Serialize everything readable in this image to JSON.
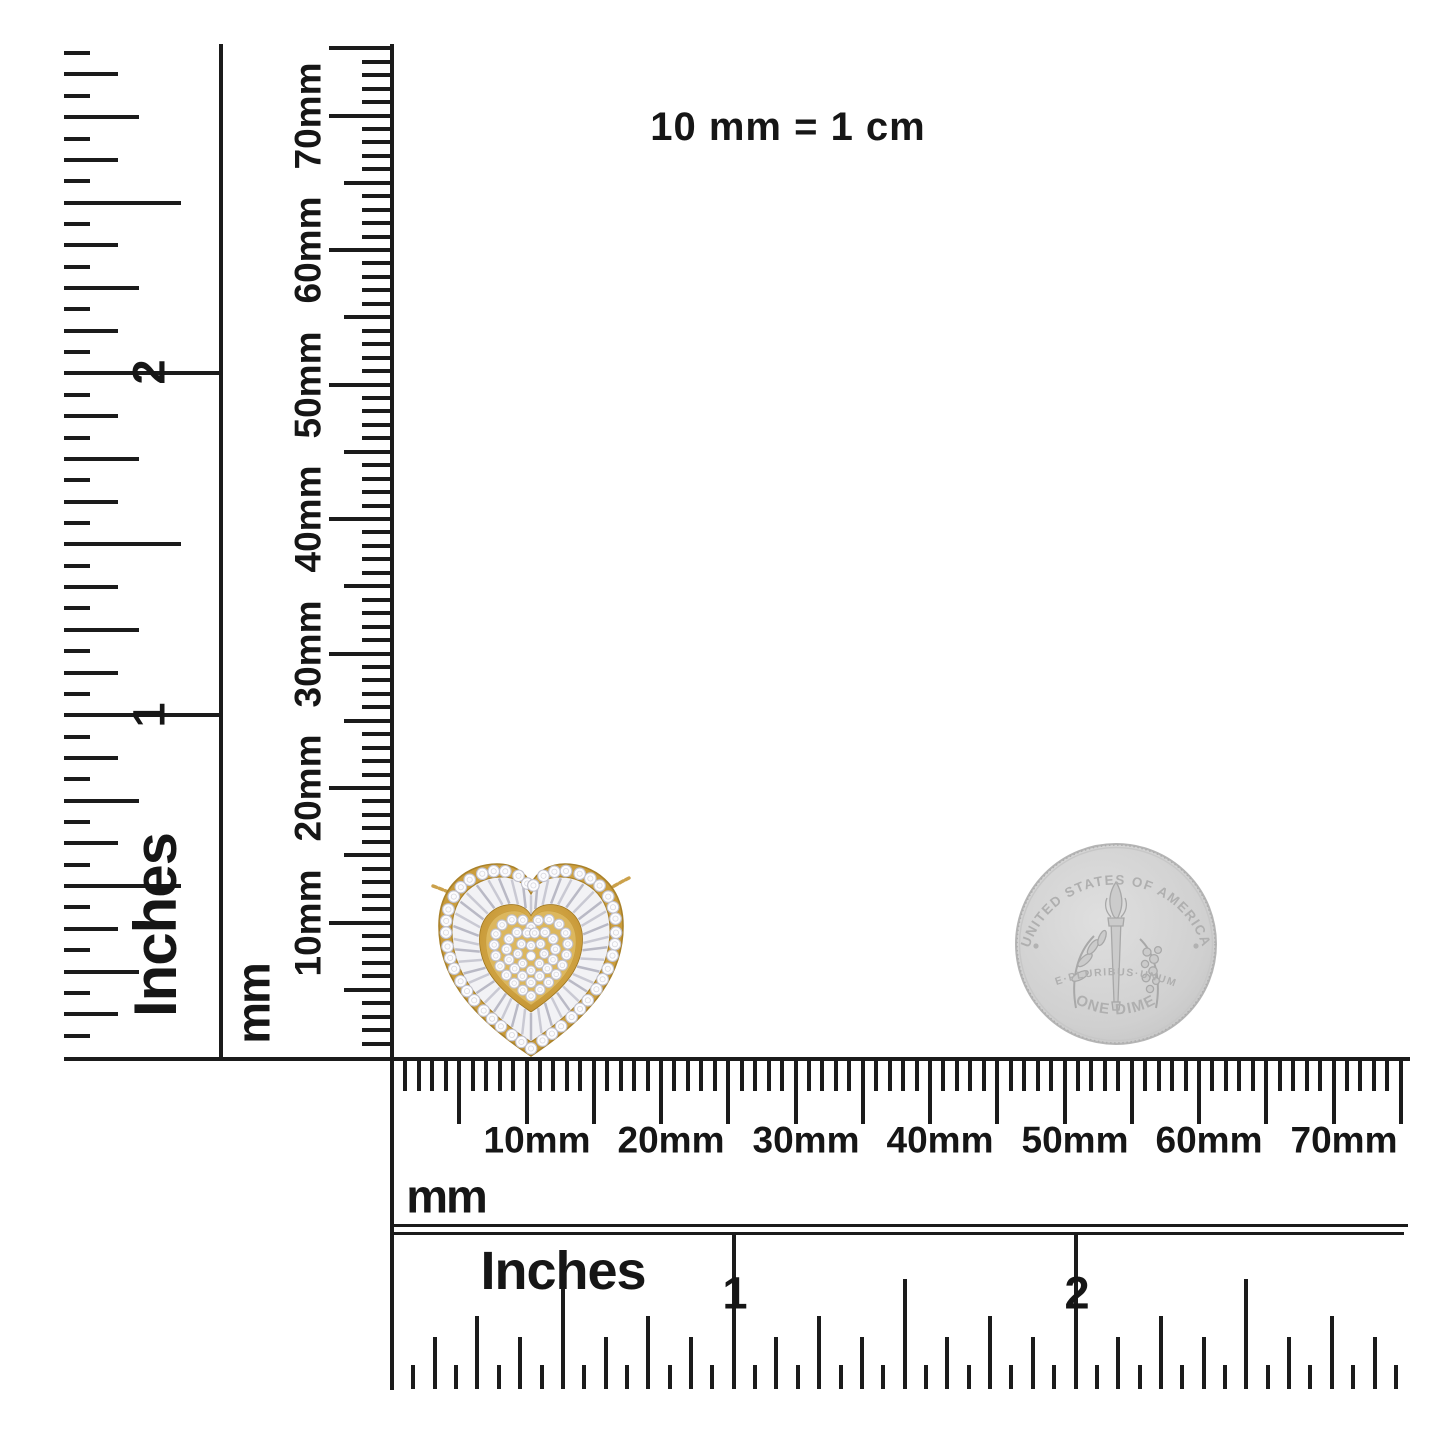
{
  "scale_note": "10 mm = 1 cm",
  "left_inch_ruler": {
    "unit": "Inches",
    "numeral_2": "2",
    "numeral_1": "1"
  },
  "left_mm_ruler": {
    "unit": "mm",
    "labels": [
      "70mm",
      "60mm",
      "50mm",
      "40mm",
      "30mm",
      "20mm",
      "10mm"
    ]
  },
  "bottom_mm_ruler": {
    "unit": "mm",
    "labels": [
      "10mm",
      "20mm",
      "30mm",
      "40mm",
      "50mm",
      "60mm",
      "70mm"
    ]
  },
  "bottom_inch_ruler": {
    "unit": "Inches",
    "numeral_1": "1",
    "numeral_2": "2"
  },
  "pendant": {
    "description": "yellow-gold heart halo pendant with round pave center, baguette ring and round diamond halo on a gold chain",
    "gold": "#d2a647",
    "gold_dark": "#a9812a",
    "gold_light": "#f0d78f",
    "gold_inner": "#dcb75e",
    "bezel_edge": "#9c741f",
    "stone": "#fcfcfe",
    "stone_edge": "#c1c1cb",
    "baguette_field": "#f2f2f5",
    "spoke_a": "#c9c9d3",
    "spoke_b": "#b9b9c5",
    "chain": "#cba14b"
  },
  "coin": {
    "top_text": "UNITED STATES OF AMERICA",
    "middle_text": "E·PLURIBUS·UNUM",
    "bottom_text": "ONE DIME",
    "silver": "#d0d0d0",
    "silver_edge": "#b5b5b5",
    "emboss": "#a8a8a8"
  }
}
